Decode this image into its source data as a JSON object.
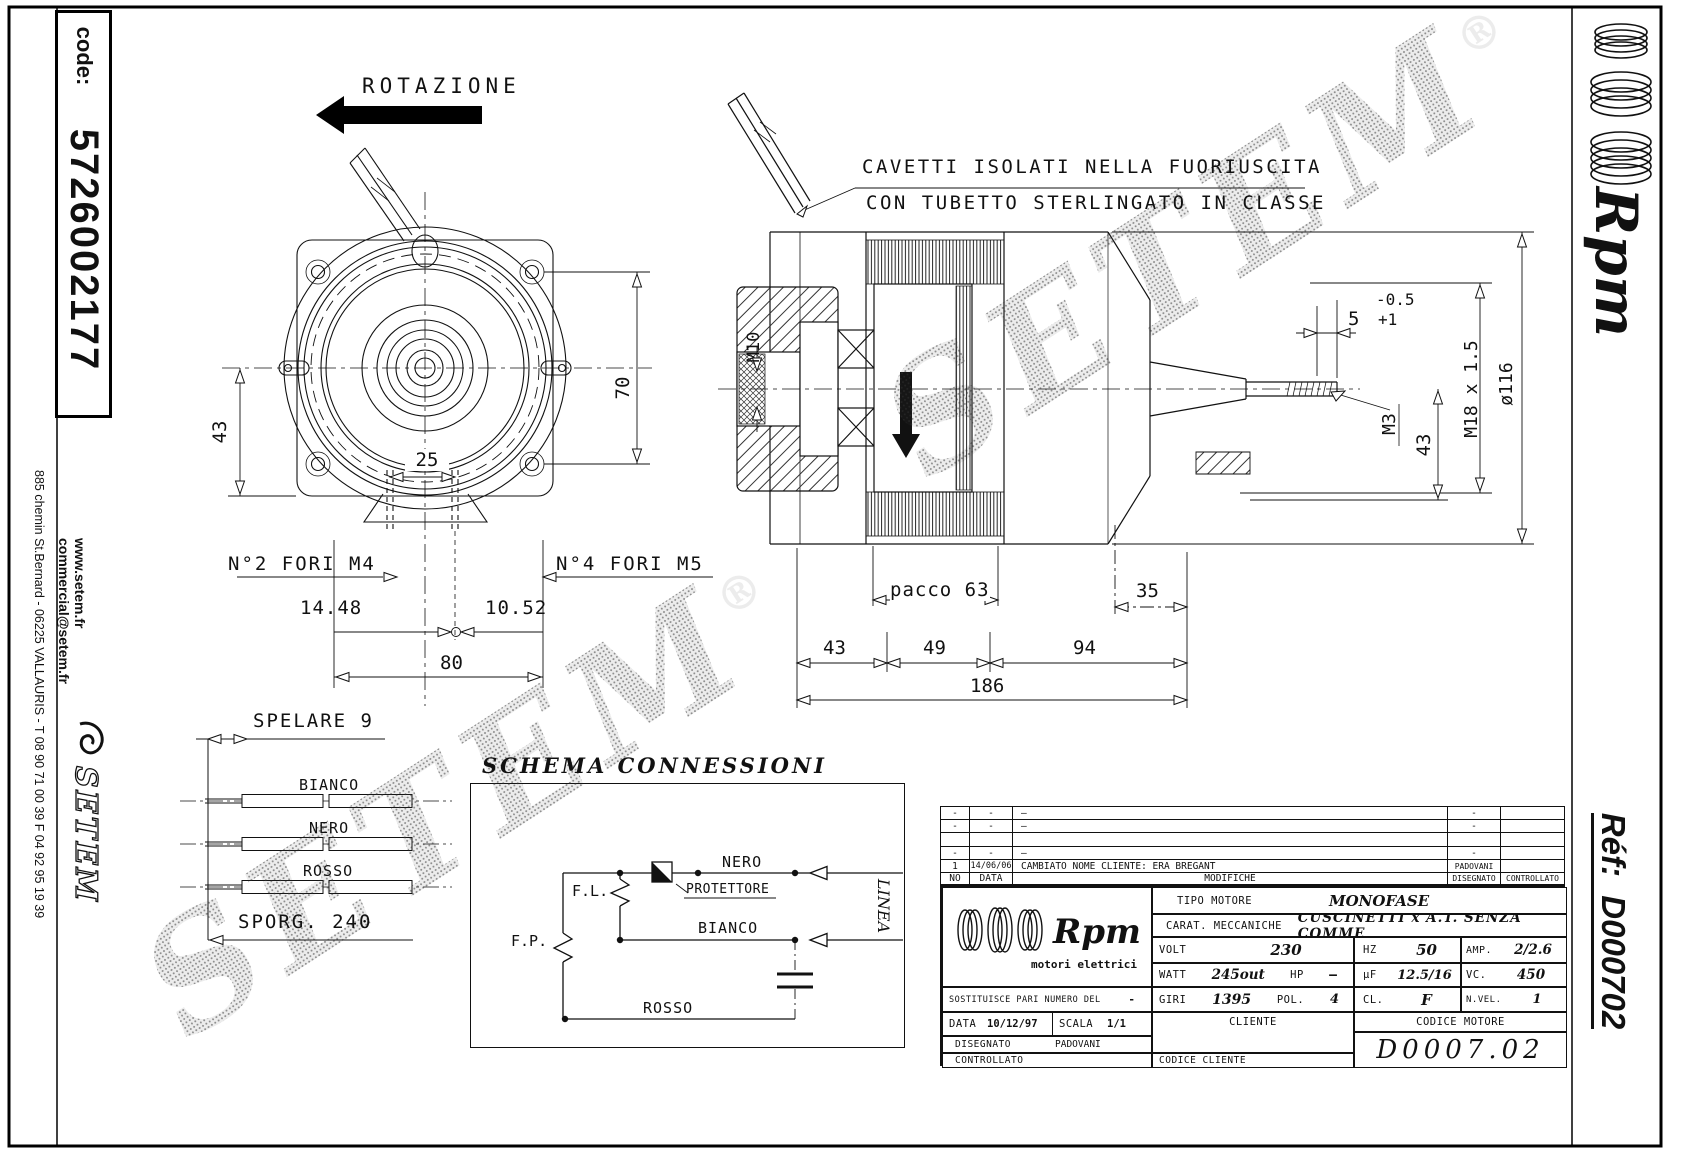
{
  "sheet": {
    "code_label": "code:",
    "code_value": "5726002177",
    "website": "www.setem.fr",
    "email": "commercial@setem.fr",
    "address_phone": "885 chemin St.Bernard  -  06225 VALLAURIS  -  T 08 90 71 00 39   F 04 92 95 19 39",
    "setem_logo_text": "SETEM",
    "watermark_text": "SETEM",
    "watermark_reg": "®",
    "brand_script": "Rpm",
    "ref_label": "Réf:",
    "ref_value": "D000702"
  },
  "front_view": {
    "rotation_label": "ROTAZIONE",
    "dim_43": "43",
    "dim_70": "70",
    "dim_25": "25",
    "dim_14_48": "14.48",
    "dim_10_52": "10.52",
    "dim_80": "80",
    "note_holes_m4": "N°2 FORI M4",
    "note_holes_m5": "N°4 FORI M5"
  },
  "side_view": {
    "note_line1": "CAVETTI ISOLATI NELLA FUORIUSCITA",
    "note_line2": "CON TUBETTO STERLINGATO IN CLASSE",
    "dim_m10": "M10",
    "dim_5": "5",
    "tol_plus": "+1",
    "tol_minus": "-0.5",
    "dim_m3": "M3",
    "dim_43_shaft": "43",
    "dim_thread": "M18 x 1.5",
    "dim_d116": "ø116",
    "dim_pacco": "pacco 63",
    "dim_35": "35",
    "dim_43": "43",
    "dim_49": "49",
    "dim_94": "94",
    "dim_186": "186"
  },
  "leads": {
    "strip_label": "SPELARE 9",
    "protrusion_label": "SPORG. 240",
    "wires": [
      "BIANCO",
      "NERO",
      "ROSSO"
    ]
  },
  "schema": {
    "title": "SCHEMA CONNESSIONI",
    "fl": "F.L.",
    "fp": "F.P.",
    "protettore": "PROTETTORE",
    "nero": "NERO",
    "bianco": "BIANCO",
    "rosso": "ROSSO",
    "linea": "LINEA"
  },
  "title_block": {
    "logo_script": "Rpm",
    "logo_sub": "motori elettrici",
    "rev_header": {
      "no": "NO",
      "date": "DATA",
      "text": "MODIFICHE",
      "by": "DISEGNATO",
      "chk": "CONTROLLATO"
    },
    "rev_rows": [
      {
        "no": "-",
        "date": "-",
        "text": "—",
        "by": "-",
        "chk": ""
      },
      {
        "no": "-",
        "date": "-",
        "text": "—",
        "by": "-",
        "chk": ""
      },
      {
        "no": "",
        "date": "",
        "text": "",
        "by": "",
        "chk": ""
      },
      {
        "no": "-",
        "date": "-",
        "text": "—",
        "by": "-",
        "chk": ""
      },
      {
        "no": "1",
        "date": "14/06/06",
        "text": "CAMBIATO NOME CLIENTE: ERA BREGANT",
        "by": "PADOVANI",
        "chk": ""
      }
    ],
    "tipo_label": "TIPO MOTORE",
    "tipo_value": "MONOFASE",
    "carat_label": "CARAT. MECCANICHE",
    "carat_value": "CUSCINETTI x A.T. SENZA COMME",
    "volt_label": "VOLT",
    "volt_value": "230",
    "hz_label": "HZ",
    "hz_value": "50",
    "amp_label": "AMP.",
    "amp_value": "2/2.6",
    "watt_label": "WATT",
    "watt_value": "245out",
    "hp_label": "HP",
    "hp_value": "—",
    "uf_label": "µF",
    "uf_value": "12.5/16",
    "vc_label": "VC.",
    "vc_value": "450",
    "sost_label": "SOSTITUISCE PARI NUMERO DEL",
    "sost_value": "-",
    "giri_label": "GIRI",
    "giri_value": "1395",
    "pol_label": "POL.",
    "pol_value": "4",
    "cl_label": "CL.",
    "cl_value": "F",
    "nvel_label": "N.VEL.",
    "nvel_value": "1",
    "data_label": "DATA",
    "data_value": "10/12/97",
    "scala_label": "SCALA",
    "scala_value": "1/1",
    "cliente_label": "CLIENTE",
    "cod_motore_label": "CODICE MOTORE",
    "cod_motore_value": "D0007.02",
    "disegnato_label": "DISEGNATO",
    "disegnato_value": "PADOVANI",
    "controllato_label": "CONTROLLATO",
    "cod_cliente_label": "CODICE CLIENTE"
  }
}
